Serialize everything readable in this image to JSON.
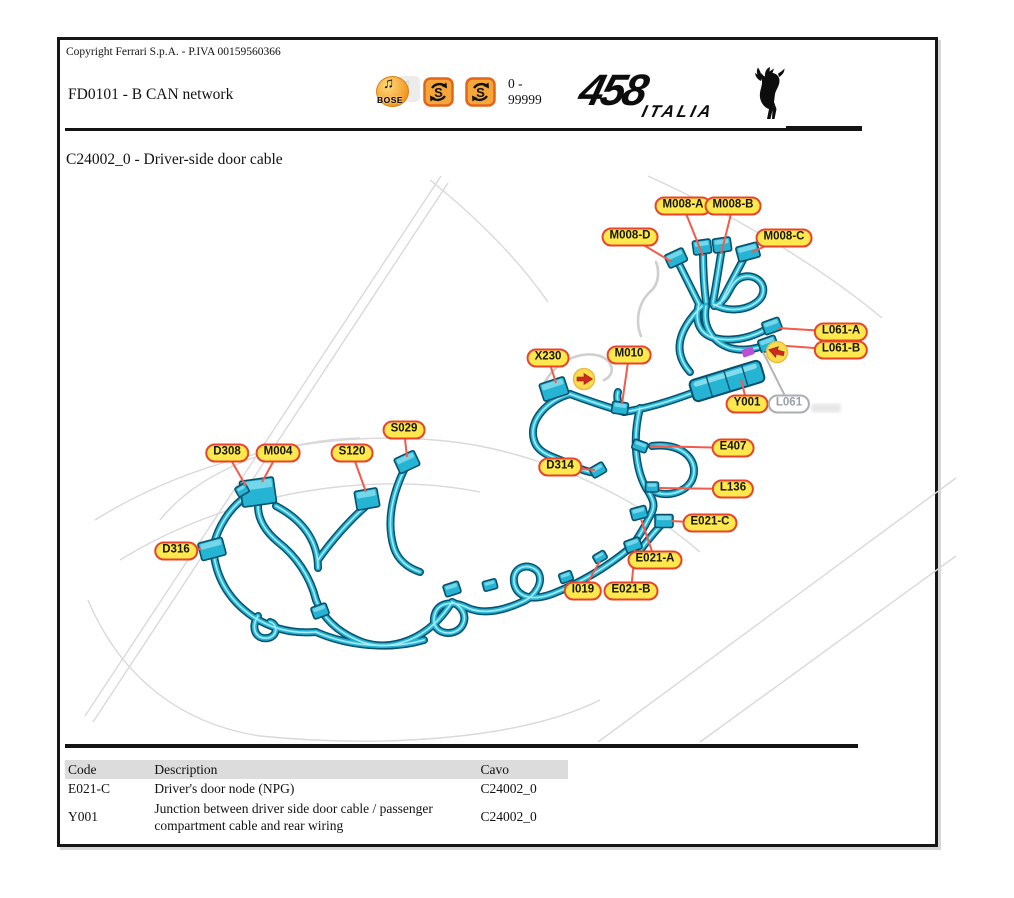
{
  "page": {
    "copyright": "Copyright Ferrari S.p.A. - P.IVA 00159560366",
    "doc_code_title": "FD0101 - B CAN network",
    "serial_range": "0 -\n99999",
    "section_title": "C24002_0 - Driver-side door cable"
  },
  "logo": {
    "model": "458",
    "variant": "ITALIA"
  },
  "header_icons": {
    "bose_label": "BOSE",
    "bose_note_glyph": "♫",
    "sync_icon_letter": "S"
  },
  "colors": {
    "harness_outline": "#07506b",
    "harness_fill": "#25b4d4",
    "harness_highlight": "#a8ecf7",
    "label_bg": "#ffe84d",
    "label_border": "#e8432b",
    "leader": "#f15b4b",
    "gray_leader": "#b5b5b5",
    "sketch": "#d9d9d9",
    "marker_fill": "#ffdc4e",
    "marker_arrow": "#cf2a1b",
    "tape_magenta": "#b84fd4"
  },
  "diagram": {
    "callouts": [
      {
        "label": "M008-A",
        "x": 683,
        "y": 206,
        "tx": 703,
        "ty": 256,
        "v": "y"
      },
      {
        "label": "M008-B",
        "x": 733,
        "y": 206,
        "tx": 721,
        "ty": 254,
        "v": "y"
      },
      {
        "label": "M008-D",
        "x": 630,
        "y": 237,
        "tx": 672,
        "ty": 262,
        "v": "y"
      },
      {
        "label": "M008-C",
        "x": 784,
        "y": 238,
        "tx": 752,
        "ty": 252,
        "v": "y"
      },
      {
        "label": "L061-A",
        "x": 841,
        "y": 332,
        "tx": 778,
        "ty": 328,
        "v": "y"
      },
      {
        "label": "L061-B",
        "x": 841,
        "y": 350,
        "tx": 774,
        "ty": 345,
        "v": "y"
      },
      {
        "label": "X230",
        "x": 548,
        "y": 358,
        "tx": 556,
        "ty": 383,
        "v": "y"
      },
      {
        "label": "M010",
        "x": 629,
        "y": 355,
        "tx": 622,
        "ty": 404,
        "v": "y"
      },
      {
        "label": "Y001",
        "x": 747,
        "y": 404,
        "tx": 741,
        "ty": 379,
        "v": "y"
      },
      {
        "label": "L061",
        "x": 789,
        "y": 404,
        "tx": 763,
        "ty": 352,
        "v": "gray"
      },
      {
        "label": "S029",
        "x": 404,
        "y": 430,
        "tx": 407,
        "ty": 457,
        "v": "y"
      },
      {
        "label": "D308",
        "x": 227,
        "y": 453,
        "tx": 246,
        "ty": 486,
        "v": "y"
      },
      {
        "label": "M004",
        "x": 278,
        "y": 453,
        "tx": 262,
        "ty": 482,
        "v": "y"
      },
      {
        "label": "S120",
        "x": 352,
        "y": 453,
        "tx": 366,
        "ty": 492,
        "v": "y"
      },
      {
        "label": "E407",
        "x": 733,
        "y": 448,
        "tx": 650,
        "ty": 446,
        "v": "y"
      },
      {
        "label": "D314",
        "x": 560,
        "y": 467,
        "tx": 595,
        "ty": 470,
        "v": "y"
      },
      {
        "label": "L136",
        "x": 733,
        "y": 489,
        "tx": 659,
        "ty": 488,
        "v": "y"
      },
      {
        "label": "E021-C",
        "x": 710,
        "y": 523,
        "tx": 671,
        "ty": 521,
        "v": "y"
      },
      {
        "label": "E021-A",
        "x": 655,
        "y": 560,
        "tx": 641,
        "ty": 519,
        "v": "y"
      },
      {
        "label": "I019",
        "x": 583,
        "y": 591,
        "tx": 600,
        "ty": 561,
        "v": "y"
      },
      {
        "label": "E021-B",
        "x": 631,
        "y": 591,
        "tx": 635,
        "ty": 550,
        "v": "y"
      },
      {
        "label": "D316",
        "x": 176,
        "y": 551,
        "tx": 201,
        "ty": 549,
        "v": "y"
      }
    ],
    "markers": [
      {
        "x": 584,
        "y": 379,
        "rot": 0
      },
      {
        "x": 777,
        "y": 352,
        "rot": 195
      }
    ],
    "tape": {
      "x": 748,
      "y": 352,
      "rot": -20
    },
    "junction": {
      "x": 727,
      "y": 381,
      "w": 74,
      "h": 22,
      "rot": -17
    },
    "watermark_smudges": [
      {
        "x": 762,
        "y": 406,
        "w": 58,
        "h": 9
      },
      {
        "x": 826,
        "y": 408,
        "w": 30,
        "h": 9
      }
    ],
    "harness": [
      "M 699 304 C 691 288 683 272 677 260",
      "M 706 302 C 704 286 703 266 703 250",
      "M 713 302 C 716 286 719 266 722 248",
      "M 720 304 C 728 288 738 270 746 254",
      "M 699 304 C 694 322 700 334 714 338 C 740 344 762 332 770 327",
      "M 706 306 C 702 326 712 342 730 348 C 745 352 760 348 766 344",
      "M 713 304 C 735 316 757 306 762 296 C 768 282 752 272 740 278 C 728 284 730 300 714 306",
      "M 702 306 C 678 330 672 352 690 372",
      "M 695 392 C 668 402 648 408 624 412",
      "M 624 412 C 618 404 616 398 618 392",
      "M 624 412 C 604 406 586 400 570 394",
      "M 570 394 C 548 400 528 420 534 440 C 538 456 560 458 574 466 C 586 472 596 474 601 471",
      "M 640 408 C 632 440 636 470 646 488 C 654 500 656 506 650 516",
      "M 652 446 C 684 442 700 462 692 480 C 684 496 658 498 650 488",
      "M 650 516 C 644 528 638 538 632 546",
      "M 664 522 C 656 530 648 540 641 549",
      "M 630 548 C 606 568 578 584 552 594 C 530 602 516 596 514 582 C 512 566 530 562 538 572 C 544 582 536 596 522 602",
      "M 522 602 C 500 612 482 614 468 608 C 452 600 436 602 434 618 C 432 634 454 638 462 626 C 468 616 462 606 452 602",
      "M 452 602 C 428 640 392 652 362 642 C 336 632 322 616 316 600",
      "M 316 600 C 310 576 296 556 278 542 C 266 532 258 520 258 506",
      "M 244 498 C 228 510 218 528 214 544",
      "M 214 556 C 218 582 232 602 252 616 C 270 628 292 634 316 632",
      "M 276 506 C 306 522 318 544 318 568",
      "M 318 560 C 332 540 350 520 366 506",
      "M 406 466 C 392 494 386 522 394 548 C 398 560 408 568 420 572",
      "M 316 632 C 348 646 390 650 424 640",
      "M 258 616 C 250 628 256 640 268 638 C 278 636 278 624 270 622"
    ],
    "connectors": [
      {
        "x": 676,
        "y": 258,
        "w": 20,
        "h": 14,
        "r": -25,
        "n": "M008-D"
      },
      {
        "x": 702,
        "y": 247,
        "w": 18,
        "h": 14,
        "r": -8,
        "n": "M008-A"
      },
      {
        "x": 722,
        "y": 245,
        "w": 18,
        "h": 14,
        "r": -8,
        "n": "M008-B"
      },
      {
        "x": 748,
        "y": 252,
        "w": 22,
        "h": 15,
        "r": -15,
        "n": "M008-C"
      },
      {
        "x": 772,
        "y": 326,
        "w": 18,
        "h": 13,
        "r": -20,
        "n": "L061-A"
      },
      {
        "x": 768,
        "y": 344,
        "w": 18,
        "h": 13,
        "r": -20,
        "n": "L061-B"
      },
      {
        "x": 554,
        "y": 389,
        "w": 26,
        "h": 18,
        "r": -18,
        "n": "X230"
      },
      {
        "x": 620,
        "y": 408,
        "w": 16,
        "h": 12,
        "r": 8,
        "n": "M010"
      },
      {
        "x": 598,
        "y": 470,
        "w": 15,
        "h": 11,
        "r": -30,
        "n": "D314"
      },
      {
        "x": 640,
        "y": 446,
        "w": 15,
        "h": 10,
        "r": 20,
        "n": "E407"
      },
      {
        "x": 652,
        "y": 487,
        "w": 13,
        "h": 10,
        "r": 0,
        "n": "L136"
      },
      {
        "x": 639,
        "y": 513,
        "w": 16,
        "h": 12,
        "r": -15,
        "n": "E021-A"
      },
      {
        "x": 664,
        "y": 521,
        "w": 18,
        "h": 13,
        "r": 0,
        "n": "E021-C"
      },
      {
        "x": 633,
        "y": 545,
        "w": 16,
        "h": 12,
        "r": -20,
        "n": "E021-B"
      },
      {
        "x": 600,
        "y": 557,
        "w": 13,
        "h": 9,
        "r": -30,
        "n": "I019"
      },
      {
        "x": 407,
        "y": 462,
        "w": 22,
        "h": 16,
        "r": -25,
        "n": "S029"
      },
      {
        "x": 367,
        "y": 499,
        "w": 23,
        "h": 19,
        "r": -10,
        "n": "S120"
      },
      {
        "x": 258,
        "y": 492,
        "w": 34,
        "h": 26,
        "r": -8,
        "n": "M004"
      },
      {
        "x": 242,
        "y": 490,
        "w": 12,
        "h": 10,
        "r": -30,
        "n": "D308"
      },
      {
        "x": 212,
        "y": 549,
        "w": 25,
        "h": 18,
        "r": -15,
        "n": "D316"
      },
      {
        "x": 320,
        "y": 611,
        "w": 16,
        "h": 12,
        "r": -20,
        "n": "clip"
      },
      {
        "x": 452,
        "y": 589,
        "w": 16,
        "h": 12,
        "r": -18,
        "n": "clip"
      },
      {
        "x": 490,
        "y": 585,
        "w": 14,
        "h": 10,
        "r": -15,
        "n": "clip"
      },
      {
        "x": 566,
        "y": 577,
        "w": 13,
        "h": 10,
        "r": -20,
        "n": "clip"
      }
    ],
    "sketch": [
      "M 85 716 L 441 176",
      "M 93 722 L 448 183",
      "M 430 180 C 480 220 520 262 548 302",
      "M 648 176 C 740 218 822 268 882 318",
      "M 598 742 L 956 478",
      "M 700 742 L 956 556",
      "M 95 520 C 210 448 360 424 480 446 C 560 462 640 500 700 552",
      "M 120 560 C 230 492 370 470 480 492",
      "M 88 600 C 120 676 180 724 260 736",
      "M 260 736 C 380 748 520 740 600 700",
      "M 160 520 C 200 470 280 440 360 438"
    ],
    "pale_cables": [
      "M 545 382 C 556 362 580 350 600 356 C 616 362 614 376 604 380",
      "M 641 336 C 634 318 640 300 652 290 C 658 284 660 272 656 262"
    ]
  },
  "table": {
    "headers": [
      "Code",
      "Description",
      "Cavo"
    ],
    "rows": [
      {
        "code": "E021-C",
        "description": "Driver's door node (NPG)",
        "cavo": "C24002_0"
      },
      {
        "code": "Y001",
        "description": "Junction between driver side door cable / passenger compartment cable and rear wiring",
        "cavo": "C24002_0"
      }
    ]
  }
}
